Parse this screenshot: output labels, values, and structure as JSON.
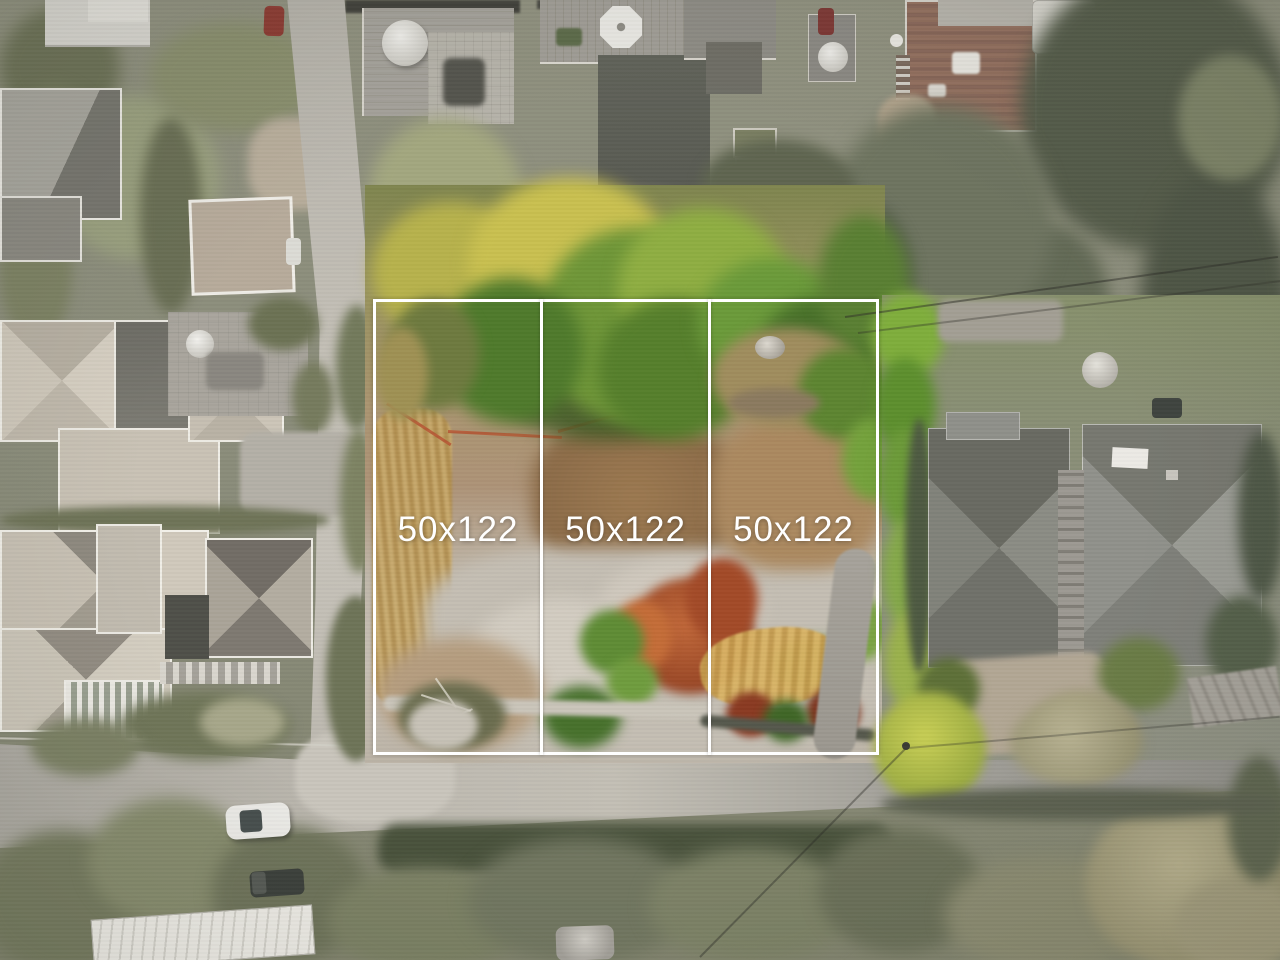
{
  "overlay": {
    "lots": [
      {
        "label": "50x122"
      },
      {
        "label": "50x122"
      },
      {
        "label": "50x122"
      }
    ]
  },
  "palette": {
    "overlay_line": "#ffffff",
    "overlay_text": "#ffffff",
    "road_gray": "#b3afa6",
    "dirt_tan": "#b9a489",
    "gravel_pale": "#c4beb3",
    "canopy_green": "#6f9638",
    "canopy_yellow": "#c9c050",
    "autumn_orange": "#b0522c",
    "roof_gray": "#83847c",
    "roof_beige": "#cfc8bb",
    "hedge_olive": "#6f7458"
  }
}
